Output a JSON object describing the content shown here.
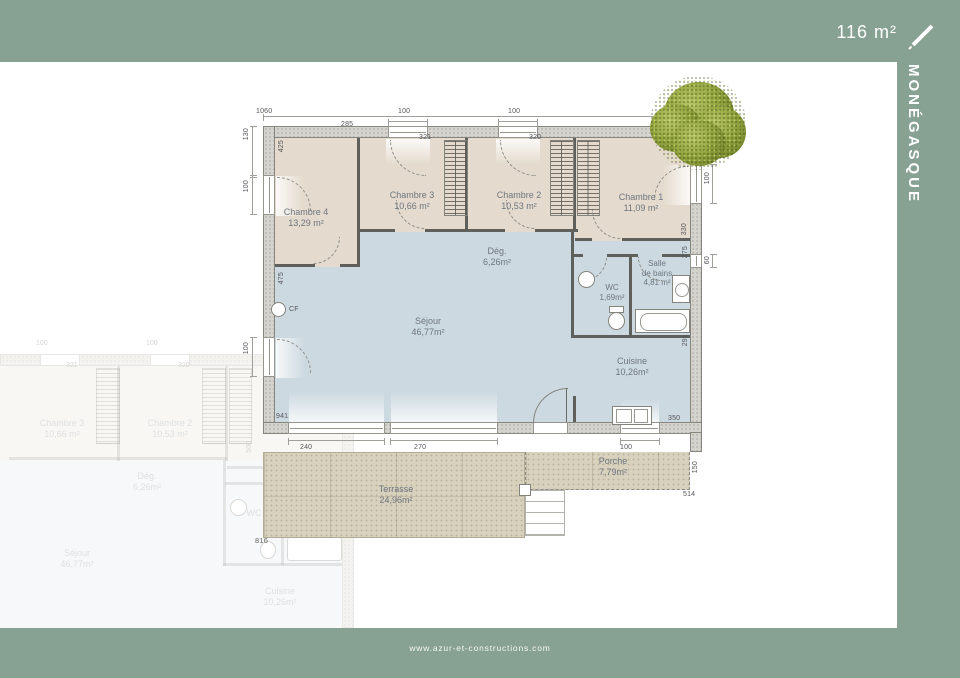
{
  "header": {
    "total_area": "116 m²"
  },
  "sidebar": {
    "model_name": "MONÉGASQUE"
  },
  "footer": {
    "website": "www.azur-et-constructions.com"
  },
  "palette": {
    "frame_green": "#87a192",
    "room_beige": "#e4dacd",
    "room_blue": "#cdd9e1",
    "terrace_sand": "#d8d1bd",
    "tree_green": "#76882c"
  },
  "plan": {
    "rooms": {
      "chambre4": {
        "name": "Chambre 4",
        "area": "13,29 m²"
      },
      "chambre3": {
        "name": "Chambre 3",
        "area": "10,66 m²"
      },
      "chambre2": {
        "name": "Chambre 2",
        "area": "10,53 m²"
      },
      "chambre1": {
        "name": "Chambre 1",
        "area": "11,09 m²"
      },
      "degagement": {
        "name": "Dég.",
        "area": "6,26m²"
      },
      "sejour": {
        "name": "Séjour",
        "area": "46,77m²"
      },
      "wc": {
        "name": "WC",
        "area": "1,69m²"
      },
      "salle_de_bains": {
        "name": "Salle",
        "name2": "de bains",
        "area": "4,81 m²"
      },
      "cuisine": {
        "name": "Cuisine",
        "area": "10,26m²"
      },
      "terrasse": {
        "name": "Terrasse",
        "area": "24,96m²"
      },
      "porche": {
        "name": "Porche",
        "area": "7,79m²"
      }
    },
    "symbols": {
      "cf_label": "CF"
    },
    "dimensions": {
      "top_total": "1060",
      "top_win1": "100",
      "top_win2": "100",
      "left_seg": "130",
      "left_win1": "100",
      "left_win2": "100",
      "c4_height": "425",
      "c4_width": "285",
      "c3_width": "321",
      "c2_width": "320",
      "c1_width": "355",
      "right_win": "100",
      "right_seg1": "330",
      "right_seg2": "275",
      "right_win2": "60",
      "right_seg3": "291",
      "right_seg4": "350",
      "sejour_height": "475",
      "bottom_bay": "941",
      "terr_seg1": "240",
      "terr_seg2": "270",
      "porch_win": "100",
      "porch_side": "150",
      "porch_width": "514",
      "dim_816": "816"
    }
  },
  "ghost": {
    "rooms": {
      "chambre3": {
        "name": "Chambre 3",
        "area": "10,66 m²"
      },
      "chambre2": {
        "name": "Chambre 2",
        "area": "10,53 m²"
      },
      "degagement": {
        "name": "Dég.",
        "area": "6,26m²"
      },
      "sejour": {
        "name": "Séjour",
        "area": "46,77m²"
      },
      "cuisine": {
        "name": "Cuisine",
        "area": "10,26m²"
      },
      "wc": {
        "name": "WC"
      },
      "salle_de_bains": {
        "name": "Salle",
        "name2": "de bains"
      }
    },
    "dimensions": {
      "win1": "100",
      "win2": "100",
      "c3_width": "321",
      "c2_width": "320",
      "right_side": "500"
    }
  }
}
